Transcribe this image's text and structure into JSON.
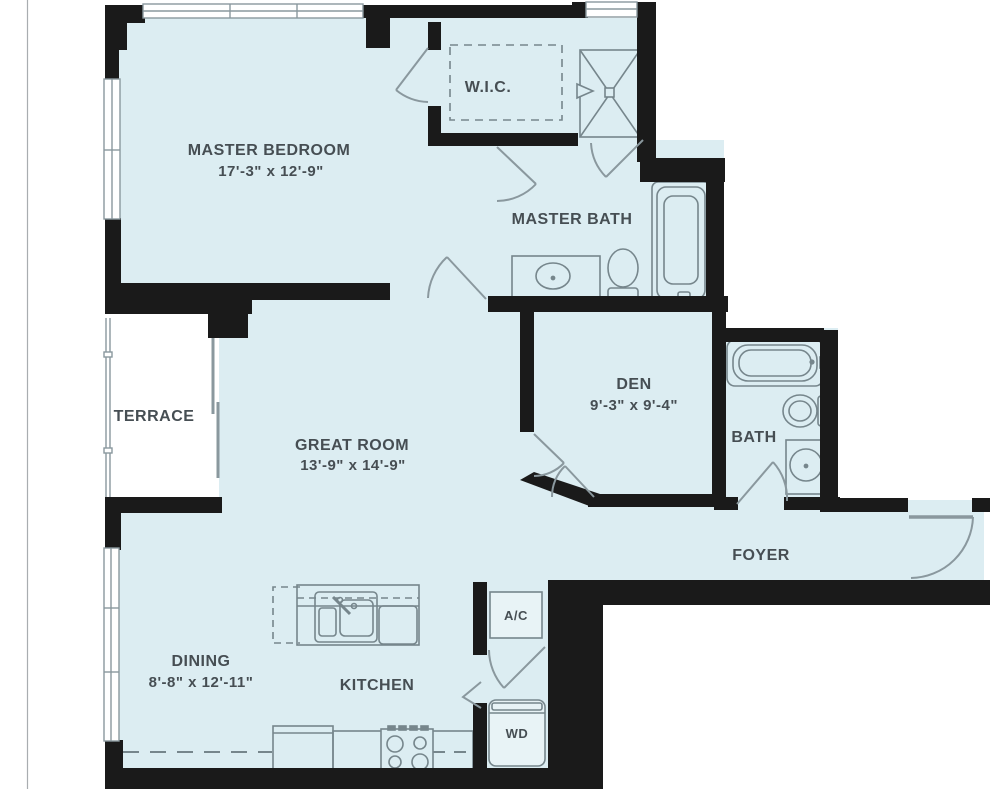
{
  "page": {
    "background": "#ffffff",
    "type": "apartment floor plan"
  },
  "palette": {
    "room_fill": "#dcedf2",
    "wall": "#1a1a1a",
    "fixture_line": "#76868c",
    "label_text": "#464e53",
    "margin_line": "#a9adb0"
  },
  "floor_plan": {
    "rooms": {
      "master_bedroom": {
        "label": "MASTER BEDROOM",
        "dimensions": "17'-3\" x 12'-9\""
      },
      "wic": {
        "label": "W.I.C."
      },
      "master_bath": {
        "label": "MASTER BATH"
      },
      "den": {
        "label": "DEN",
        "dimensions": "9'-3\" x 9'-4\""
      },
      "bath": {
        "label": "BATH"
      },
      "terrace": {
        "label": "TERRACE"
      },
      "great_room": {
        "label": "GREAT ROOM",
        "dimensions": "13'-9\" x 14'-9\""
      },
      "foyer": {
        "label": "FOYER"
      },
      "dining": {
        "label": "DINING",
        "dimensions": "8'-8\" x 12'-11\""
      },
      "kitchen": {
        "label": "KITCHEN"
      },
      "ac_closet": {
        "label": "A/C"
      },
      "laundry": {
        "label": "WD"
      }
    },
    "fixtures": {
      "master_bath": [
        "shower",
        "vanity-sink",
        "toilet",
        "bathtub"
      ],
      "bath": [
        "bathtub",
        "toilet",
        "vanity-sink"
      ],
      "kitchen": [
        "island-double-sink",
        "dishwasher",
        "refrigerator",
        "range"
      ],
      "closets": [
        "air-handler",
        "washer-dryer"
      ]
    }
  }
}
